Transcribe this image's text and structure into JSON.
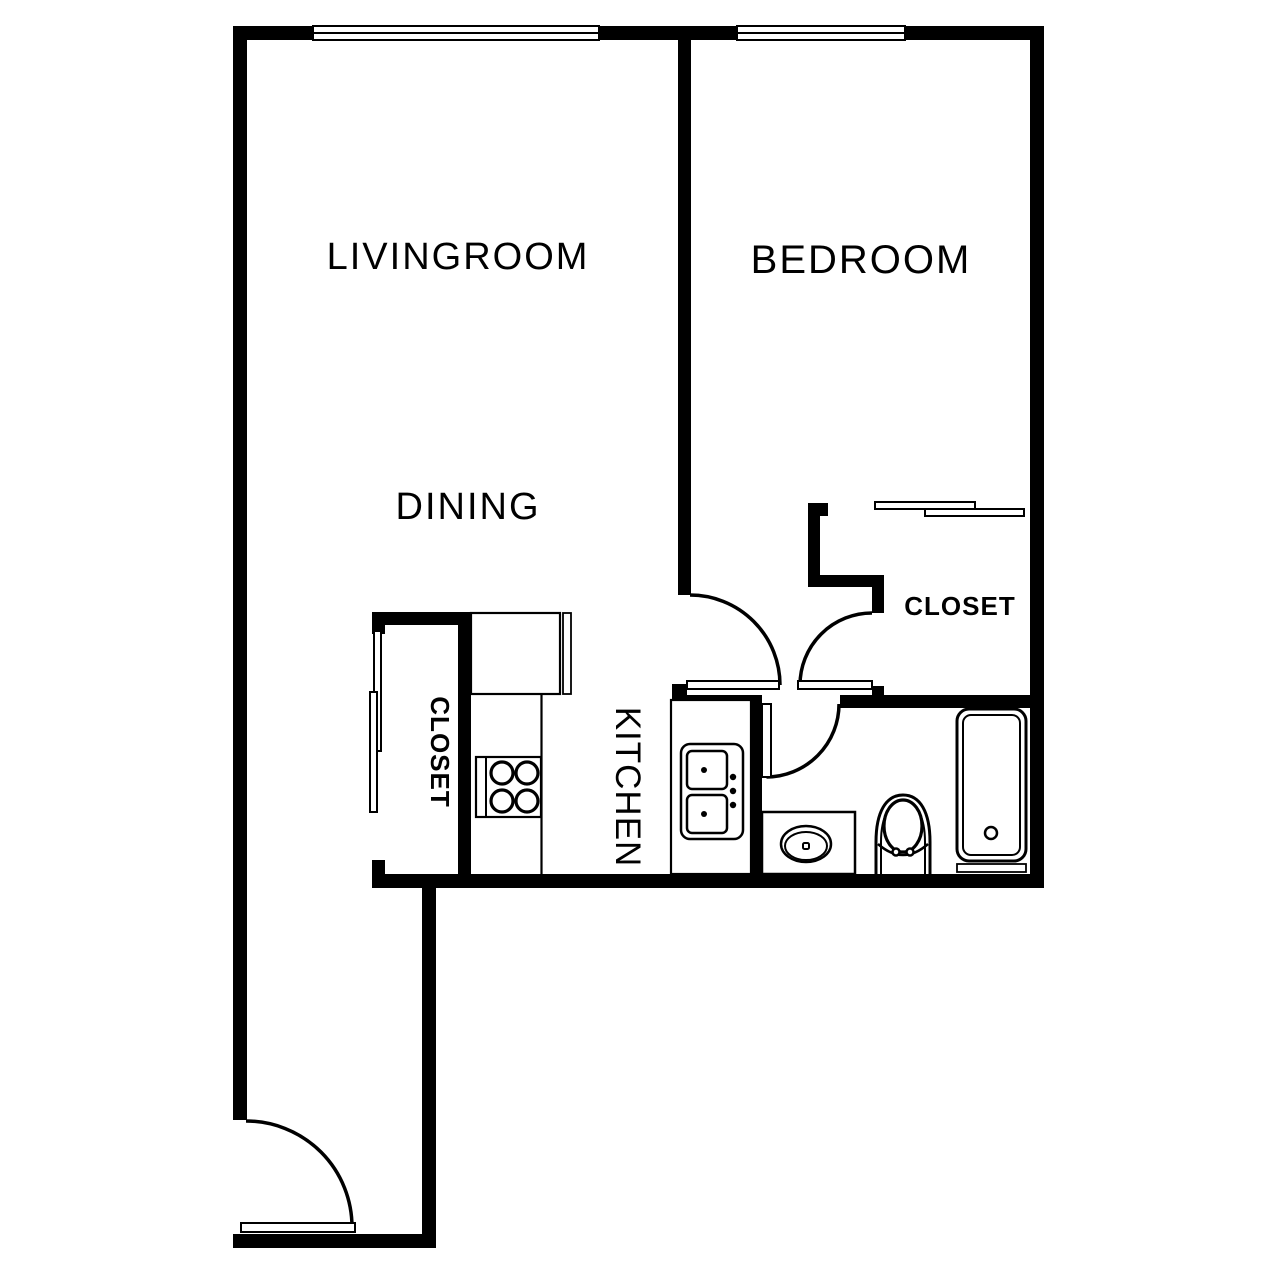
{
  "floorplan": {
    "type": "apartment-one-bedroom",
    "background_color": "#ffffff",
    "line_color": "#000000",
    "rooms": {
      "livingroom": {
        "label": "LIVINGROOM"
      },
      "dining": {
        "label": "DINING"
      },
      "bedroom": {
        "label": "BEDROOM"
      },
      "bedroom_closet": {
        "label": "CLOSET"
      },
      "hall_closet": {
        "label": "CLOSET"
      },
      "kitchen": {
        "label": "KITCHEN"
      }
    },
    "doors": [
      "entry-door",
      "bedroom-door",
      "bedroom-closet-door",
      "bathroom-door"
    ],
    "windows": [
      "livingroom-window",
      "bedroom-window"
    ],
    "fixtures": [
      "stove",
      "kitchen-counter",
      "refrigerator",
      "kitchen-sink",
      "bathroom-vanity-sink",
      "toilet",
      "bathtub",
      "sliding-closet-doors-bedroom",
      "sliding-closet-doors-hall"
    ]
  }
}
